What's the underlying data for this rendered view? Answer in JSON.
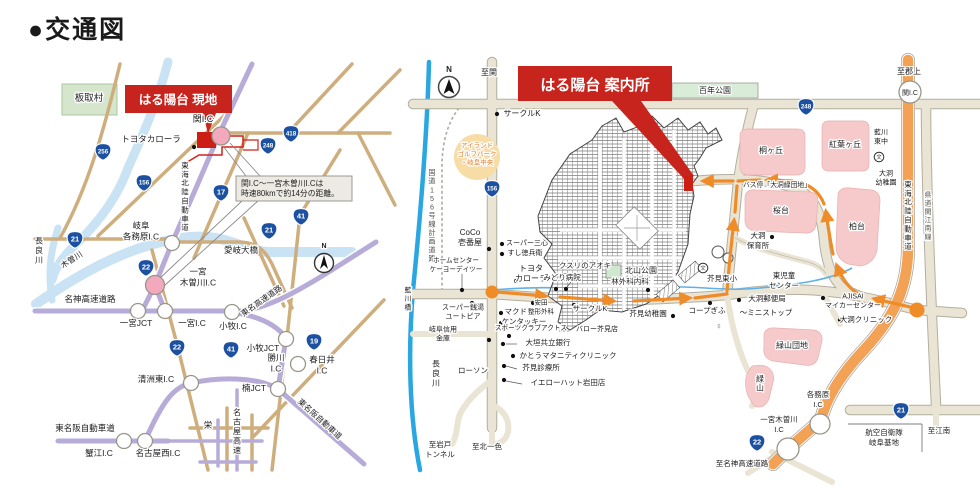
{
  "title": "●交通図",
  "colors": {
    "accent_red": "#c8241e",
    "site_red": "#cc1e14",
    "shield_blue": "#1c50a0",
    "highway_purple": "#b7abd8",
    "road_tan": "#cfae7e",
    "road_beige": "#eae4d4",
    "river_pale": "#c9e3f4",
    "river_blue": "#2aa7e0",
    "route_orange": "#f08c28",
    "expressway_orange": "#f2a155",
    "area_pink": "#f6caca",
    "park_green": "#d8ecd8",
    "node_pink": "#f2a9bd"
  },
  "left_map": {
    "banner": "はる陽台 現地",
    "callout": {
      "line1": "関I.C〜一宮木曽川I.Cは",
      "line2": "時速80kmで約14分の距離。"
    },
    "labels": [
      {
        "t": "板取村",
        "x": 89,
        "y": 101,
        "fs": 9.5
      },
      {
        "t": "トヨタカローラ",
        "x": 151,
        "y": 142,
        "fs": 8.5
      },
      {
        "t": "関I.C",
        "x": 203,
        "y": 122,
        "fs": 9
      },
      {
        "t": "東海北陸自動車道",
        "x": 185,
        "y": 199,
        "fs": 7.5,
        "v": 1
      },
      {
        "t": "岐阜\n各務原I.C",
        "x": 141,
        "y": 234,
        "fs": 8.5
      },
      {
        "t": "長良川",
        "x": 39,
        "y": 253,
        "fs": 8,
        "v": 1
      },
      {
        "t": "木曽川",
        "x": 73,
        "y": 262,
        "fs": 8,
        "r": -33
      },
      {
        "t": "愛岐大橋",
        "x": 241,
        "y": 253,
        "fs": 8.5
      },
      {
        "t": "一宮\n木曽川I.C",
        "x": 198,
        "y": 280,
        "fs": 8.5
      },
      {
        "t": "名神高速道路",
        "x": 90,
        "y": 302,
        "fs": 8.5
      },
      {
        "t": "一宮JCT",
        "x": 136,
        "y": 326,
        "fs": 8.5
      },
      {
        "t": "一宮I.C",
        "x": 192,
        "y": 326,
        "fs": 8.5
      },
      {
        "t": "小牧I.C",
        "x": 233,
        "y": 329,
        "fs": 8.5
      },
      {
        "t": "東名高速道路",
        "x": 263,
        "y": 303,
        "fs": 8,
        "r": -35
      },
      {
        "t": "小牧JCT",
        "x": 263,
        "y": 351,
        "fs": 8.5
      },
      {
        "t": "勝川\nI.C",
        "x": 276,
        "y": 366,
        "fs": 8.5
      },
      {
        "t": "春日井\nI.C",
        "x": 322,
        "y": 368,
        "fs": 8.5
      },
      {
        "t": "楠JCT",
        "x": 254,
        "y": 391,
        "fs": 8.5
      },
      {
        "t": "清洲東I.C",
        "x": 156,
        "y": 382,
        "fs": 8.5
      },
      {
        "t": "名古屋高速",
        "x": 237,
        "y": 434,
        "fs": 8,
        "v": 1
      },
      {
        "t": "栄",
        "x": 208,
        "y": 428,
        "fs": 8.5
      },
      {
        "t": "東名阪自動車道",
        "x": 85,
        "y": 431,
        "fs": 8.5
      },
      {
        "t": "蟹江I.C",
        "x": 99,
        "y": 456,
        "fs": 8.5
      },
      {
        "t": "名古屋西I.C",
        "x": 158,
        "y": 456,
        "fs": 8.5
      },
      {
        "t": "東名阪自動車道",
        "x": 318,
        "y": 421,
        "fs": 8,
        "r": 42
      },
      {
        "t": "N",
        "x": 324,
        "y": 248,
        "fs": 7,
        "b": 1
      }
    ],
    "shields": [
      {
        "n": "256",
        "x": 103,
        "y": 152
      },
      {
        "n": "156",
        "x": 144,
        "y": 183
      },
      {
        "n": "17",
        "x": 221,
        "y": 193
      },
      {
        "n": "418",
        "x": 291,
        "y": 134
      },
      {
        "n": "248",
        "x": 268,
        "y": 146
      },
      {
        "n": "41",
        "x": 301,
        "y": 217
      },
      {
        "n": "21",
        "x": 269,
        "y": 231
      },
      {
        "n": "21",
        "x": 75,
        "y": 240
      },
      {
        "n": "22",
        "x": 146,
        "y": 268
      },
      {
        "n": "22",
        "x": 177,
        "y": 348
      },
      {
        "n": "41",
        "x": 231,
        "y": 350
      },
      {
        "n": "19",
        "x": 314,
        "y": 342
      }
    ],
    "nodes": [
      {
        "x": 221,
        "y": 136,
        "r": 9,
        "c": "pink"
      },
      {
        "x": 172,
        "y": 243,
        "r": 7.5
      },
      {
        "x": 155,
        "y": 285,
        "r": 9.5,
        "c": "pink"
      },
      {
        "x": 138,
        "y": 311,
        "r": 7.5
      },
      {
        "x": 165,
        "y": 311,
        "r": 7.5
      },
      {
        "x": 232,
        "y": 312,
        "r": 7.5
      },
      {
        "x": 286,
        "y": 339,
        "r": 7.5
      },
      {
        "x": 298,
        "y": 364,
        "r": 7.5
      },
      {
        "x": 278,
        "y": 389,
        "r": 7.5
      },
      {
        "x": 191,
        "y": 383,
        "r": 7.5
      },
      {
        "x": 124,
        "y": 441,
        "r": 7.5
      },
      {
        "x": 145,
        "y": 441,
        "r": 7.5
      }
    ],
    "dots": [
      {
        "x": 194,
        "y": 147
      }
    ]
  },
  "right_map": {
    "banner": "はる陽台 案内所",
    "labels": [
      {
        "t": "至関",
        "x": 489,
        "y": 75,
        "fs": 8
      },
      {
        "t": "至郡上",
        "x": 909,
        "y": 74,
        "fs": 8
      },
      {
        "t": "関I.C",
        "x": 910,
        "y": 95,
        "fs": 7
      },
      {
        "t": "サークルK",
        "x": 522,
        "y": 116,
        "fs": 8
      },
      {
        "t": "百年公園",
        "x": 715,
        "y": 93,
        "fs": 8
      },
      {
        "t": "アイランド\nゴルフパーク\n・岐阜中央",
        "x": 477,
        "y": 156,
        "fs": 6.5,
        "fill": "#e07820"
      },
      {
        "t": "国道156号線計画道路",
        "x": 432,
        "y": 218,
        "fs": 7.2,
        "v": 1,
        "fill": "#555555"
      },
      {
        "t": "CoCo\n壱番屋",
        "x": 470,
        "y": 240,
        "fs": 8
      },
      {
        "t": "スーパー三心",
        "x": 527,
        "y": 245,
        "fs": 7
      },
      {
        "t": "すし徳兵衛",
        "x": 525,
        "y": 255,
        "fs": 7
      },
      {
        "t": "ホームセンター\nケーヨーデイツー",
        "x": 456,
        "y": 267,
        "fs": 6.6
      },
      {
        "t": "トヨタ\nカローラ",
        "x": 531,
        "y": 276,
        "fs": 8
      },
      {
        "t": "みどり病院",
        "x": 562,
        "y": 280,
        "fs": 7.5
      },
      {
        "t": "クスリのアオキ",
        "x": 585,
        "y": 268,
        "fs": 7.5
      },
      {
        "t": "北山公園",
        "x": 641,
        "y": 273,
        "fs": 8
      },
      {
        "t": "林外科内科",
        "x": 630,
        "y": 284,
        "fs": 7.5
      },
      {
        "t": "スーパー銭湯\nユートピア",
        "x": 463,
        "y": 314,
        "fs": 7
      },
      {
        "t": "マクドナルド",
        "x": 527,
        "y": 314,
        "fs": 7.5
      },
      {
        "t": "ケンタッキー",
        "x": 524,
        "y": 324,
        "fs": 7.5
      },
      {
        "t": "安田\n整形外科",
        "x": 541,
        "y": 309,
        "fs": 6.5
      },
      {
        "t": "サークルK",
        "x": 590,
        "y": 311,
        "fs": 7.5
      },
      {
        "t": "芥見幼稚園",
        "x": 648,
        "y": 316,
        "fs": 7.5
      },
      {
        "t": "コープぎふ",
        "x": 707,
        "y": 313,
        "fs": 7.5
      },
      {
        "t": "〜ミニストップ",
        "x": 766,
        "y": 315,
        "fs": 7.5
      },
      {
        "t": "大洞郵便局",
        "x": 767,
        "y": 301,
        "fs": 7.5
      },
      {
        "t": "AJISAI\nマイカーセンター",
        "x": 853,
        "y": 303,
        "fs": 7
      },
      {
        "t": "大洞クリニック",
        "x": 866,
        "y": 322,
        "fs": 7.5
      },
      {
        "t": "芥見東小",
        "x": 722,
        "y": 281,
        "fs": 7.5
      },
      {
        "t": "東児童\nセンター",
        "x": 784,
        "y": 283,
        "fs": 7.5
      },
      {
        "t": "大洞\n保育所",
        "x": 758,
        "y": 243,
        "fs": 7.5
      },
      {
        "t": "バス停「大洞緑団地」",
        "x": 777,
        "y": 187,
        "fs": 6.8
      },
      {
        "t": "桐ヶ丘",
        "x": 771,
        "y": 153,
        "fs": 8
      },
      {
        "t": "紅葉ヶ丘",
        "x": 845,
        "y": 147,
        "fs": 8
      },
      {
        "t": "桜台",
        "x": 781,
        "y": 213,
        "fs": 8
      },
      {
        "t": "柏台",
        "x": 857,
        "y": 229,
        "fs": 8
      },
      {
        "t": "緑山団地",
        "x": 792,
        "y": 348,
        "fs": 8
      },
      {
        "t": "緑山",
        "x": 760,
        "y": 386,
        "fs": 8,
        "v": 1
      },
      {
        "t": "藍川\n東中",
        "x": 881,
        "y": 139,
        "fs": 7
      },
      {
        "t": "大洞\n幼稚園",
        "x": 886,
        "y": 180,
        "fs": 7
      },
      {
        "t": "東海北陸自動車道",
        "x": 908,
        "y": 218,
        "fs": 7.5,
        "v": 1
      },
      {
        "t": "県道関江南線",
        "x": 928,
        "y": 218,
        "fs": 7,
        "v": 1,
        "fill": "#555555"
      },
      {
        "t": "各務原\nI.C",
        "x": 818,
        "y": 402,
        "fs": 7.5
      },
      {
        "t": "一宮木曽川\nI.C",
        "x": 779,
        "y": 427,
        "fs": 7.5
      },
      {
        "t": "至名神高速道路",
        "x": 742,
        "y": 466,
        "fs": 7.5
      },
      {
        "t": "航空自衛隊\n岐阜基地",
        "x": 884,
        "y": 440,
        "fs": 7.5
      },
      {
        "t": "至江南",
        "x": 939,
        "y": 433,
        "fs": 7.5
      },
      {
        "t": "長良川",
        "x": 436,
        "y": 376,
        "fs": 8,
        "v": 1
      },
      {
        "t": "藍川橋",
        "x": 408,
        "y": 301,
        "fs": 7,
        "v": 1
      },
      {
        "t": "至岩戸\nトンネル",
        "x": 440,
        "y": 452,
        "fs": 7.5
      },
      {
        "t": "至北一色",
        "x": 487,
        "y": 449,
        "fs": 7.5
      },
      {
        "t": "岐阜信用\n金庫",
        "x": 443,
        "y": 336,
        "fs": 7
      },
      {
        "t": "スポーツクラブアクトス",
        "x": 531,
        "y": 330,
        "fs": 6.6
      },
      {
        "t": "バロー芥見店",
        "x": 597,
        "y": 331,
        "fs": 7
      },
      {
        "t": "大垣共立銀行",
        "x": 548,
        "y": 345,
        "fs": 7.5
      },
      {
        "t": "かとうマタニティクリニック",
        "x": 568,
        "y": 358,
        "fs": 7.5
      },
      {
        "t": "芥見診療所",
        "x": 541,
        "y": 370,
        "fs": 7.5
      },
      {
        "t": "ローソン",
        "x": 473,
        "y": 373,
        "fs": 7.5
      },
      {
        "t": "イエローハット岩田店",
        "x": 568,
        "y": 385,
        "fs": 7.5
      },
      {
        "t": "♀",
        "x": 719,
        "y": 329,
        "fs": 9,
        "fill": "#666666"
      },
      {
        "t": "N",
        "x": 449,
        "y": 72,
        "fs": 8,
        "b": 1
      }
    ],
    "shields": [
      {
        "n": "156",
        "x": 492,
        "y": 189
      },
      {
        "n": "248",
        "x": 806,
        "y": 107
      },
      {
        "n": "21",
        "x": 901,
        "y": 411
      },
      {
        "n": "22",
        "x": 757,
        "y": 443
      }
    ],
    "nodes": [
      {
        "x": 910,
        "y": 92,
        "r": 11
      },
      {
        "x": 820,
        "y": 424,
        "r": 10
      },
      {
        "x": 788,
        "y": 449,
        "r": 11
      },
      {
        "x": 492,
        "y": 292,
        "r": 6.5,
        "c": "orange"
      },
      {
        "x": 917,
        "y": 310,
        "r": 7.5,
        "c": "orange"
      }
    ],
    "dots": [
      {
        "x": 497,
        "y": 114
      },
      {
        "x": 489,
        "y": 249
      },
      {
        "x": 502,
        "y": 244
      },
      {
        "x": 502,
        "y": 254
      },
      {
        "x": 462,
        "y": 290
      },
      {
        "x": 516,
        "y": 281
      },
      {
        "x": 556,
        "y": 289
      },
      {
        "x": 566,
        "y": 289
      },
      {
        "x": 533,
        "y": 303
      },
      {
        "x": 501,
        "y": 313
      },
      {
        "x": 501,
        "y": 323
      },
      {
        "x": 472,
        "y": 303
      },
      {
        "x": 574,
        "y": 305
      },
      {
        "x": 673,
        "y": 316
      },
      {
        "x": 710,
        "y": 303
      },
      {
        "x": 739,
        "y": 300
      },
      {
        "x": 823,
        "y": 298
      },
      {
        "x": 840,
        "y": 320
      },
      {
        "x": 772,
        "y": 237
      },
      {
        "x": 489,
        "y": 340
      },
      {
        "x": 509,
        "y": 336
      },
      {
        "x": 503,
        "y": 344
      },
      {
        "x": 513,
        "y": 356
      },
      {
        "x": 504,
        "y": 366
      },
      {
        "x": 504,
        "y": 380
      },
      {
        "x": 648,
        "y": 290
      }
    ],
    "schools": [
      {
        "x": 703,
        "y": 268
      },
      {
        "x": 879,
        "y": 157
      }
    ]
  }
}
